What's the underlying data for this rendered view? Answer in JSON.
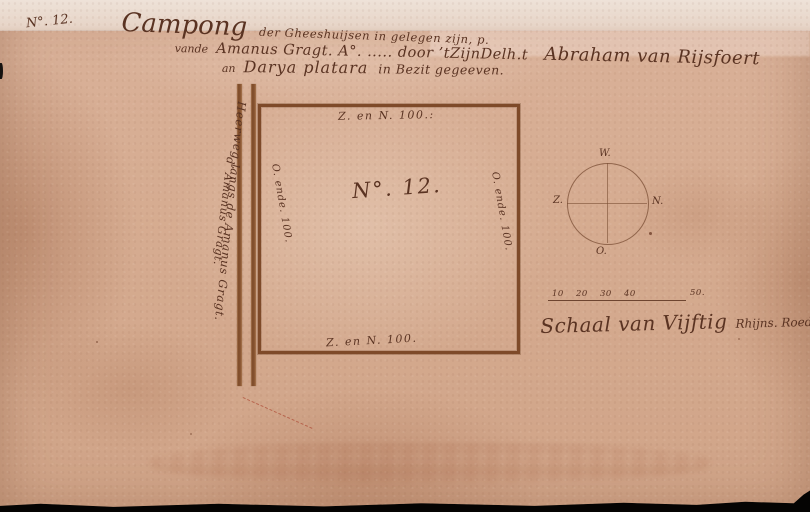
{
  "document": {
    "doc_number": "N°. 12.",
    "title": {
      "campong": "Campong",
      "line1_rest": "der Gheeshuijsen in gelegen zijn, p.",
      "line2_vande": "vande",
      "line2_mid": "Amanus Gragt. A°. ..... door ’tZijnDelh.t",
      "line2_name": "Abraham van Rijsfoert",
      "line3_an": "an",
      "line3_name": "Darya platara",
      "line3_rest": "in Bezit gegeeven."
    }
  },
  "plot": {
    "center_label": "N°. 12.",
    "side_top": "Z. en N. 100.:",
    "side_bottom": "Z. en N. 100.",
    "side_left": "O. ende. 100.",
    "side_right": "O. ende. 100."
  },
  "road": {
    "label_inner": "Heerweg langs de Amanus Gragt.",
    "label_outer": "d’ Amanus Gragt."
  },
  "compass": {
    "top": "W.",
    "right": "N.",
    "bottom": "O.",
    "left": "Z."
  },
  "scale": {
    "ticks": [
      "10",
      "20",
      "30",
      "40",
      "50."
    ],
    "caption_main": "Schaal van Vijftig",
    "caption_suffix": "Rhijns. Roede."
  },
  "colors": {
    "paper": "#d6ac91",
    "paper_strip": "#e9d9cd",
    "ink": "#5a3322",
    "plot_line": "#7e4a29",
    "red_dash": "#b0503a"
  }
}
